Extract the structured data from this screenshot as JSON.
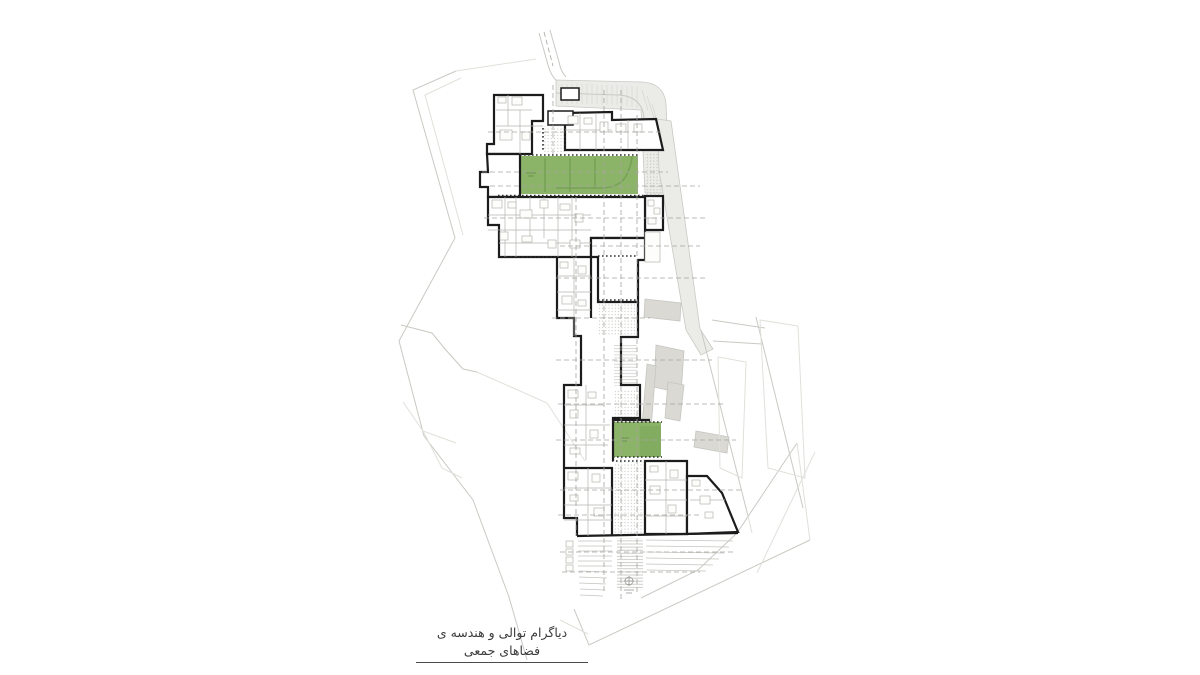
{
  "canvas": {
    "width": 1200,
    "height": 675,
    "background": "#ffffff"
  },
  "caption": {
    "text": "دیاگرام توالی و هندسه ی فضاهای جمعی",
    "lang": "fa",
    "direction": "rtl"
  },
  "colors": {
    "background": "#ffffff",
    "building_outline": "#1c1c1c",
    "green_space": "#8cb469",
    "green_space_dark": "#719e50",
    "context_line": "#c9c9c4",
    "context_fill": "#ebebe8",
    "context_fill_dark": "#dad9d4",
    "detail_line": "#b5b5b0",
    "axis_dash": "#a5a5a0"
  },
  "plan": {
    "green_spaces": [
      {
        "id": "courtyard-upper",
        "x": 520,
        "y": 156,
        "width": 118,
        "height": 38
      },
      {
        "id": "courtyard-middle",
        "x": 598,
        "y": 256,
        "width": 38,
        "height": 42
      },
      {
        "id": "courtyard-lower",
        "x": 614,
        "y": 422,
        "width": 47,
        "height": 35
      }
    ]
  }
}
